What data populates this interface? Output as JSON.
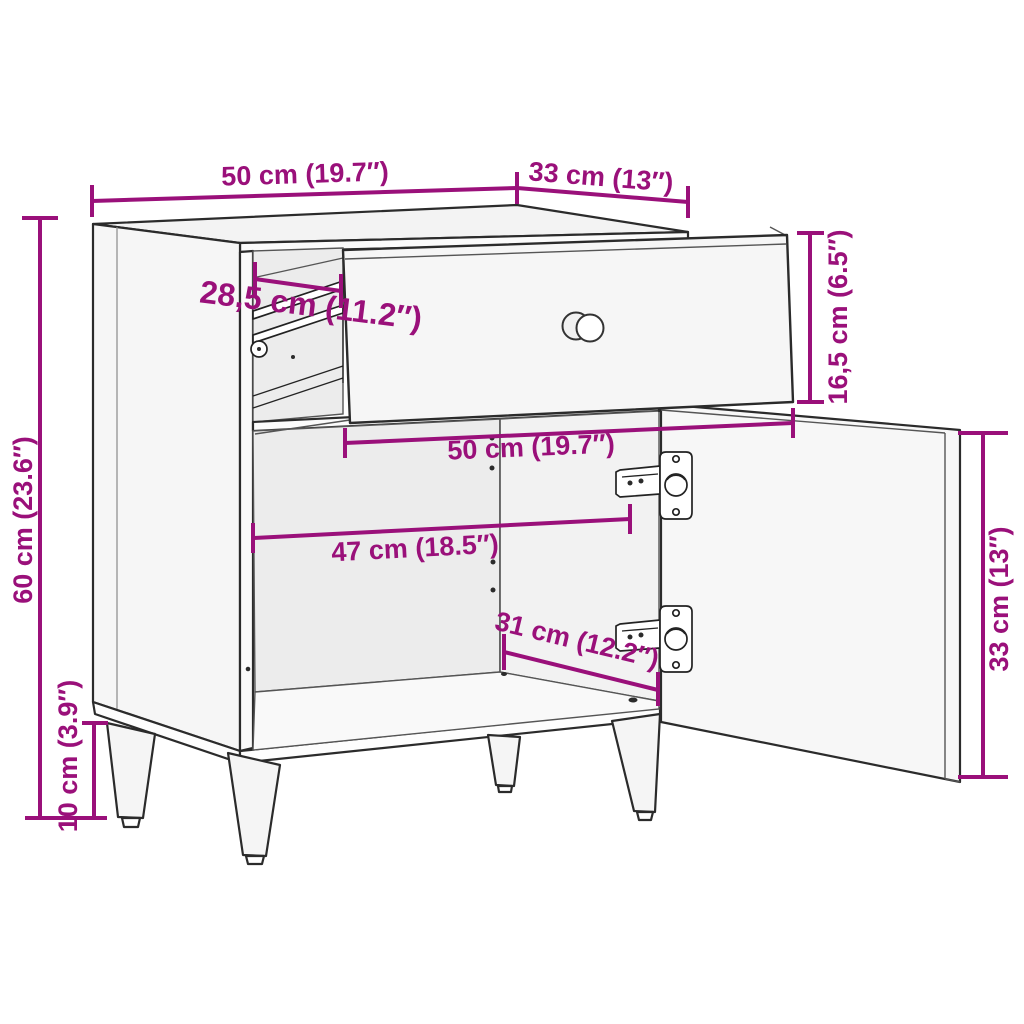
{
  "diagram": {
    "title": "Cabinet with drawer and door — dimension diagram",
    "accent_color": "#9A107A",
    "outline_color": "#2b2b2b",
    "dimensions": [
      {
        "id": "top-width",
        "label": "50 cm (19.7″)"
      },
      {
        "id": "top-depth",
        "label": "33 cm (13″)"
      },
      {
        "id": "drawer-extension",
        "label": "28,5 cm (11.2″)"
      },
      {
        "id": "drawer-front-height",
        "label": "16,5 cm (6.5″)"
      },
      {
        "id": "drawer-front-width",
        "label": "50 cm (19.7″)"
      },
      {
        "id": "interior-width",
        "label": "47 cm (18.5″)"
      },
      {
        "id": "interior-depth",
        "label": "31 cm (12.2″)"
      },
      {
        "id": "door-height",
        "label": "33 cm (13″)"
      },
      {
        "id": "body-height",
        "label": "60 cm (23.6″)"
      },
      {
        "id": "leg-height",
        "label": "10 cm (3.9″)"
      }
    ]
  }
}
